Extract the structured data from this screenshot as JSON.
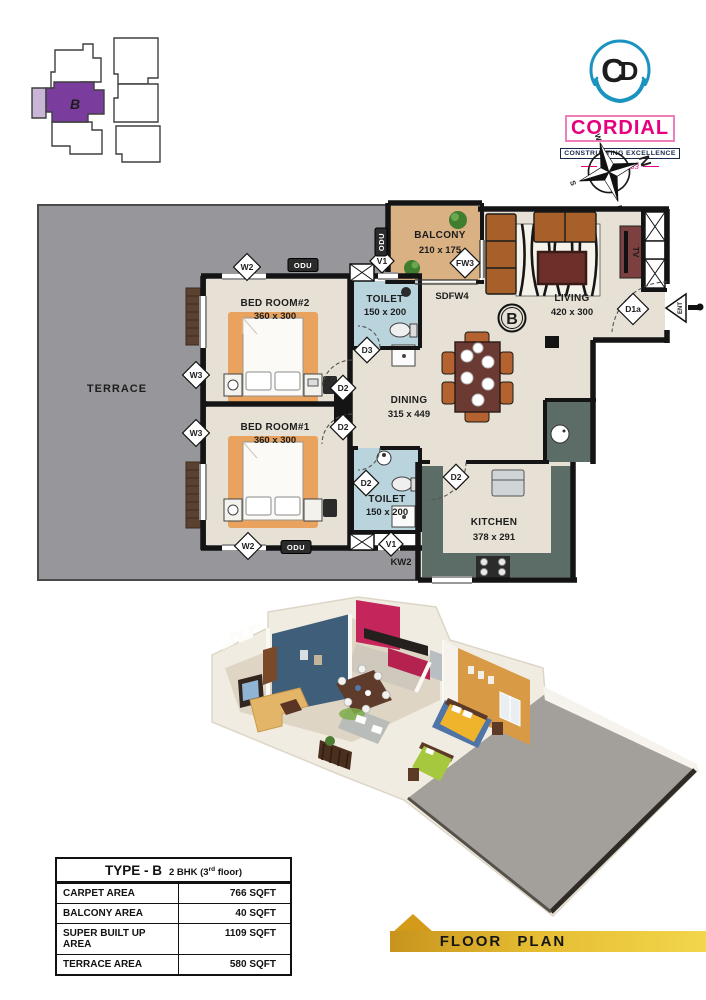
{
  "header": {
    "keyplan": {
      "unit": "B"
    },
    "logo": {
      "monogram_c": "C",
      "monogram_d": "D",
      "brand": "CORDIAL",
      "tagline": "CONSTRUCTING EXCELLENCE",
      "since": "Since 1983"
    },
    "compass": {
      "n": "N",
      "e": "E",
      "s": "S",
      "w": "W"
    }
  },
  "floorplan": {
    "unit_badge": "B",
    "rooms": {
      "terrace": {
        "name": "TERRACE"
      },
      "bedroom2": {
        "name": "BED ROOM#2",
        "dims": "360 x 300"
      },
      "bedroom1": {
        "name": "BED ROOM#1",
        "dims": "360 x 300"
      },
      "toilet_top": {
        "name": "TOILET",
        "dims": "150 x 200"
      },
      "toilet_bottom": {
        "name": "TOILET",
        "dims": "150 x 200"
      },
      "balcony": {
        "name": "BALCONY",
        "dims": "210 x 175"
      },
      "living": {
        "name": "LIVING",
        "dims": "420 x 300"
      },
      "dining": {
        "name": "DINING",
        "dims": "315 x 449"
      },
      "kitchen": {
        "name": "KITCHEN",
        "dims": "378 x 291"
      }
    },
    "markers": {
      "w2": "W2",
      "w3": "W3",
      "v1": "V1",
      "d2": "D2",
      "d3": "D3",
      "fw3": "FW3",
      "sdfw4": "SDFW4",
      "d1a": "D1a",
      "kw2": "KW2",
      "odu": "ODU",
      "ent": "ENT",
      "tv": "TV"
    }
  },
  "area_table": {
    "title": "TYPE - B",
    "subtitle_pre": "2 BHK (3",
    "subtitle_sup": "rd",
    "subtitle_post": " floor)",
    "rows": [
      {
        "label": "CARPET AREA",
        "value": "766 SQFT"
      },
      {
        "label": "BALCONY AREA",
        "value": "40 SQFT"
      },
      {
        "label": "SUPER BUILT UP AREA",
        "value": "1109 SQFT"
      },
      {
        "label": "TERRACE AREA",
        "value": "580 SQFT"
      }
    ]
  },
  "banner": {
    "label": "FLOOR PLAN"
  },
  "colors": {
    "brand_pink": "#e6007e",
    "brand_blue": "#1b93c0",
    "terrace_gray": "#97969b",
    "floor_beige": "#e6e1d4",
    "balcony_tan": "#d9b183",
    "toilet_blue": "#b9d4dd",
    "rug_orange": "#eaa35e",
    "counter_teal": "#5c6d68",
    "banner_gold": "#e5bc32",
    "keyplan_purple": "#7a3d9e"
  }
}
